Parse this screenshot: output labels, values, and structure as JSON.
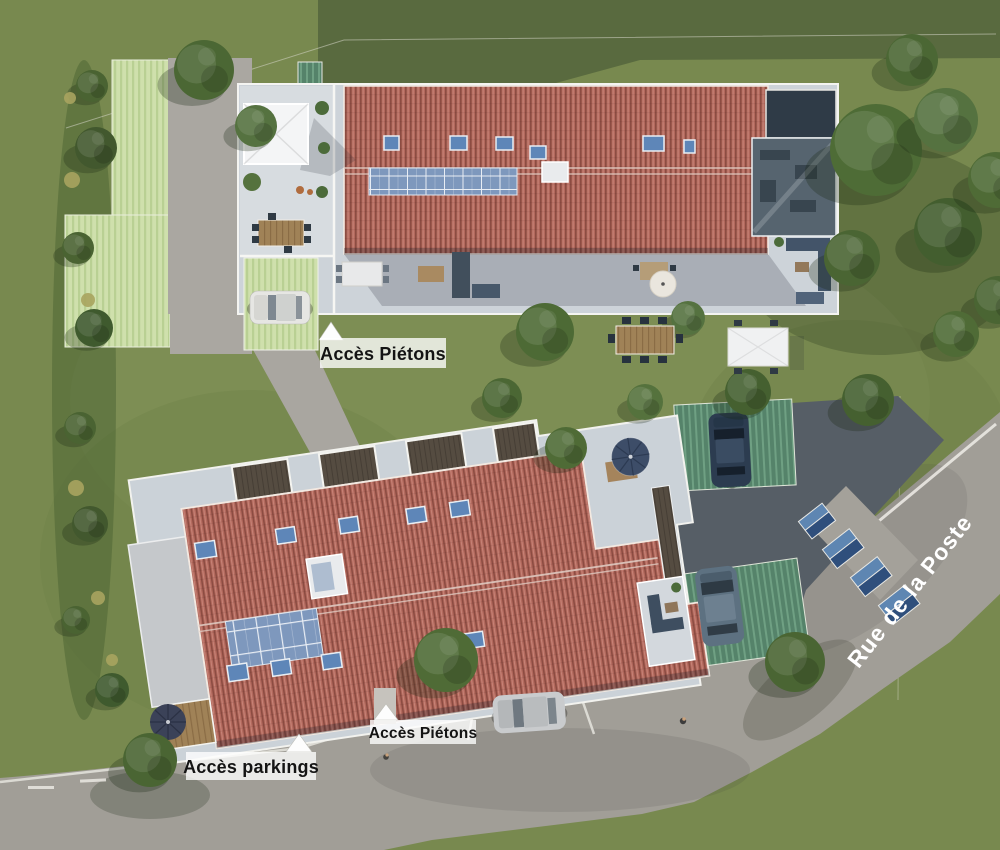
{
  "site_plan": {
    "street": {
      "name": "Rue de la Poste"
    },
    "annotations": {
      "acces_pietons_nord": "Accès Piétons",
      "acces_pietons_sud": "Accès Piétons",
      "acces_parkings": "Accès parkings"
    },
    "colors": {
      "grass": "#78894f",
      "grass_shade": "#55673d",
      "roof_tiles": "#b2685c",
      "terrace_slab": "#cdd3d9",
      "road_asphalt": "#a19e97",
      "parking_asphalt": "#565e66",
      "paver_light_green": "#cfe0ac",
      "paver_teal_green": "#55836a",
      "solar_panel_blue": "#7e98bd",
      "label_background": "rgba(255,255,255,0.78)",
      "label_text": "#141414",
      "street_label_text": "#ffffff"
    }
  }
}
